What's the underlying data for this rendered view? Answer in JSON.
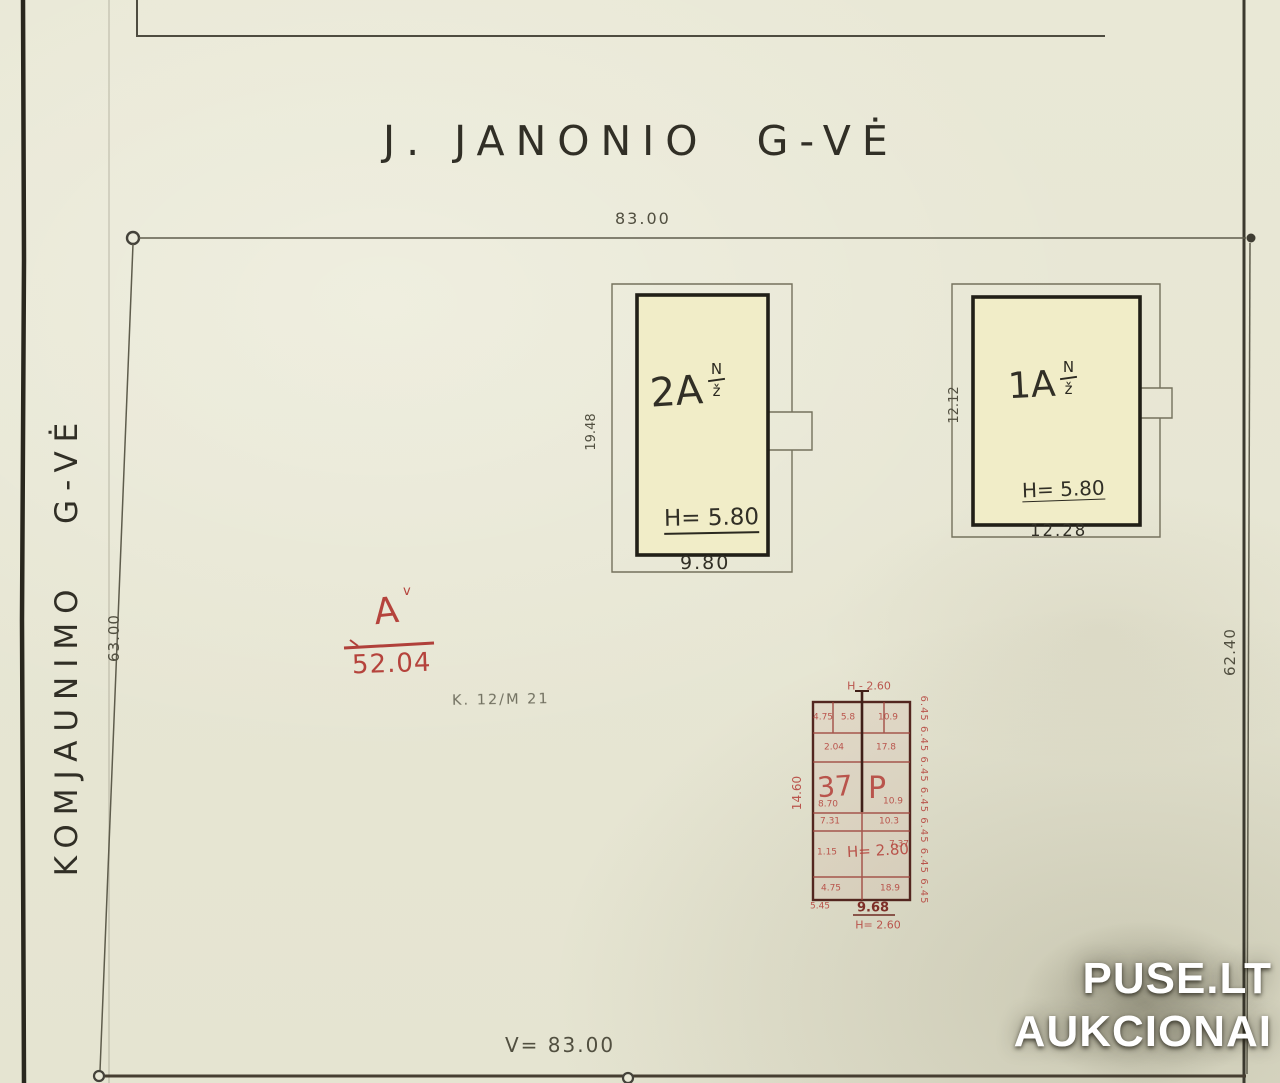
{
  "colors": {
    "paper": "#e9e8d6",
    "ink": "#312f26",
    "line": "#5e5c4c",
    "building_fill": "#f1edc8",
    "accent_red": "#b5433c",
    "watermark_white": "#ffffff"
  },
  "streets": {
    "top": "J. JANONIO  G-VĖ",
    "left": "KOMJAUNIMO   G-VĖ"
  },
  "plot": {
    "width_top": "83.00",
    "width_bottom": "V= 83.00",
    "depth_left": "63.00",
    "depth_right": "62.40",
    "survey_note": "K. 12/M 21"
  },
  "buildings": {
    "b2a": {
      "label": "2A",
      "frac_top": "N",
      "frac_bottom": "ž",
      "height": "H= 5.80",
      "width": "9.80",
      "depth": "19.48"
    },
    "b1a": {
      "label": "1A",
      "frac_top": "N",
      "frac_bottom": "ž",
      "height": "H= 5.80",
      "width": "12.28",
      "depth": "12.12"
    }
  },
  "red_marks": {
    "point": {
      "label": "A",
      "sup": "v",
      "value": "52.04"
    },
    "grid": {
      "top": "H - 2.60",
      "left": "14.60",
      "right_column": "6.45 6.45 6.45 6.45 6.45 6.45 6.45",
      "big_left": "37",
      "big_center": "P",
      "inner_height": "H= 2.80",
      "bottom_left": "5.45",
      "bottom_center": "9.68",
      "bottom_value": "H= 2.60",
      "cells": [
        "4.75",
        "5.8",
        "10.9",
        "2.04",
        "17.8",
        "8.70",
        "10.9",
        "7.31",
        "10.3",
        "1.15",
        "7.37",
        "4.75",
        "18.9"
      ]
    }
  },
  "watermark": {
    "line1": "PUSE.LT",
    "line2": "AUKCIONAI"
  }
}
